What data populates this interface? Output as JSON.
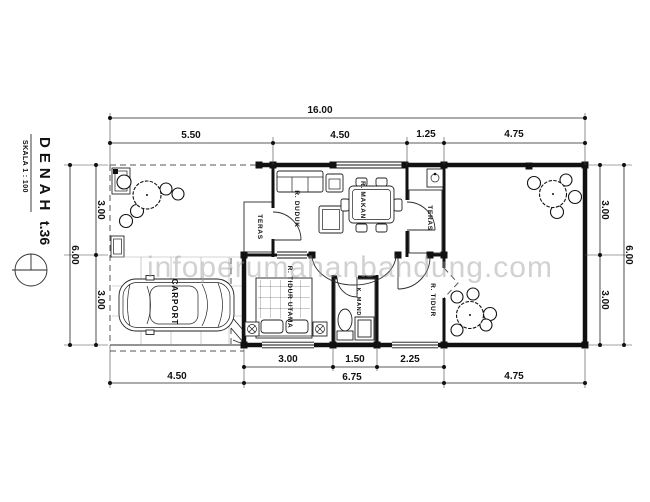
{
  "drawing_title": {
    "title": "DENAH",
    "type_label": "t.36",
    "scale_label": "SKALA 1 : 100"
  },
  "watermark": {
    "text": "infoperumahanbandung.com",
    "color": "#bbbbbb"
  },
  "rooms": [
    {
      "id": "teras-front",
      "label": "TERAS"
    },
    {
      "id": "r-duduk",
      "label": "R. DUDUK"
    },
    {
      "id": "r-makan",
      "label": "R. MAKAN"
    },
    {
      "id": "teras-side",
      "label": "TERAS"
    },
    {
      "id": "r-tidur-utama",
      "label": "R. TIDUR UTAMA"
    },
    {
      "id": "k-mandi",
      "label": "K. MANDI"
    },
    {
      "id": "r-tidur",
      "label": "R. TIDUR"
    },
    {
      "id": "carport",
      "label": "CARPORT"
    }
  ],
  "dimensions": {
    "top": {
      "total": "16.00",
      "segments": [
        "5.50",
        "4.50",
        "1.25",
        "4.75"
      ]
    },
    "bottom": {
      "inner_segments": [
        "3.00",
        "1.50",
        "2.25"
      ],
      "outer_segments": [
        "4.50",
        "6.75",
        "4.75"
      ]
    },
    "left": {
      "total": "6.00",
      "segments": [
        "3.00",
        "3.00"
      ]
    },
    "right": {
      "total": "6.00",
      "segments": [
        "3.00",
        "3.00"
      ]
    }
  }
}
